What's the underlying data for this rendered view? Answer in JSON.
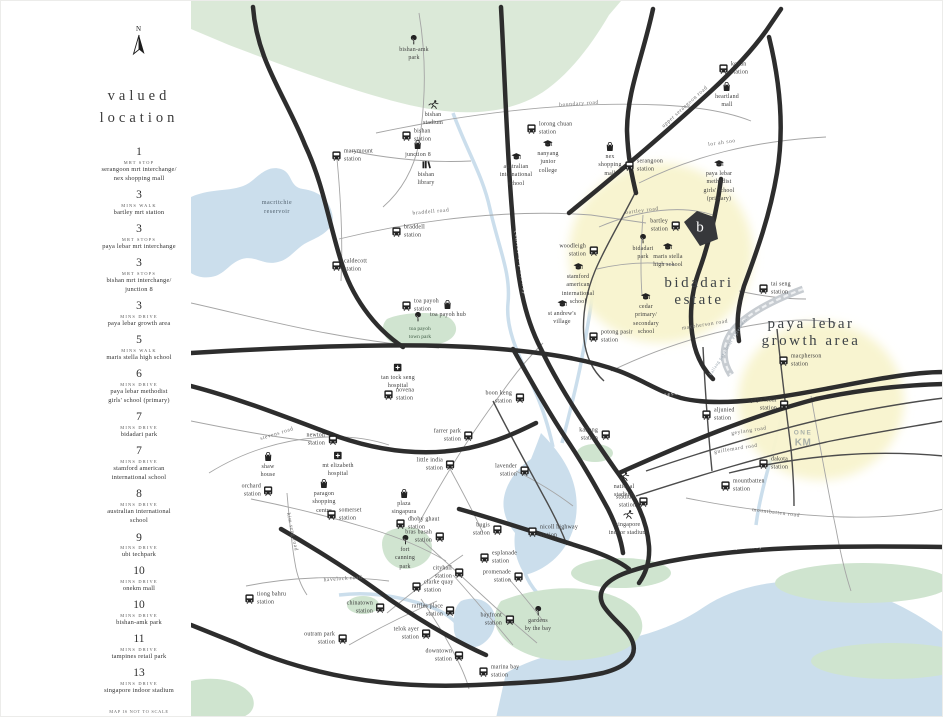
{
  "sidebar": {
    "compass": "N",
    "title": "valued\nlocation",
    "items": [
      {
        "number": "1",
        "mode": "mrt stop",
        "name": "serangoon mrt interchange/\nnex shopping mall"
      },
      {
        "number": "3",
        "mode": "mins walk",
        "name": "bartley mrt station"
      },
      {
        "number": "3",
        "mode": "mrt stops",
        "name": "paya lebar mrt interchange"
      },
      {
        "number": "3",
        "mode": "mrt stops",
        "name": "bishan mrt interchange/\njunction 8"
      },
      {
        "number": "3",
        "mode": "mins drive",
        "name": "paya lebar growth area"
      },
      {
        "number": "5",
        "mode": "mins walk",
        "name": "maris stella high school"
      },
      {
        "number": "6",
        "mode": "mins drive",
        "name": "paya lebar methodist\ngirls' school (primary)"
      },
      {
        "number": "7",
        "mode": "mins drive",
        "name": "bidadari park"
      },
      {
        "number": "7",
        "mode": "mins drive",
        "name": "stamford american\ninternational school"
      },
      {
        "number": "8",
        "mode": "mins drive",
        "name": "australian international\nschool"
      },
      {
        "number": "9",
        "mode": "mins drive",
        "name": "ubi techpark"
      },
      {
        "number": "10",
        "mode": "mins drive",
        "name": "onekm mall"
      },
      {
        "number": "10",
        "mode": "mins drive",
        "name": "bishan-amk park"
      },
      {
        "number": "11",
        "mode": "mins drive",
        "name": "tampines retail park"
      },
      {
        "number": "13",
        "mode": "mins drive",
        "name": "singapore indoor stadium"
      }
    ],
    "footnote": "map is not to scale\ndrive time is based on smooth traffic"
  },
  "map": {
    "colors": {
      "highlight_yellow": "#f8f3cd",
      "water_blue": "#cbdeec",
      "park_green": "#dbe9d8",
      "road_black": "#2d2d2d"
    },
    "area_labels": [
      {
        "text": "bidadari\nestate",
        "x": 508,
        "y": 291
      },
      {
        "text": "paya lebar\ngrowth area",
        "x": 620,
        "y": 332
      }
    ],
    "water_labels": [
      {
        "text": "macritchie\nreservoir",
        "x": 86,
        "y": 207
      }
    ],
    "park_labels": [
      {
        "text": "toa payoh\ntown park",
        "x": 229,
        "y": 333
      }
    ],
    "road_labels": [
      {
        "text": "boundary road",
        "x": 388,
        "y": 103,
        "rot": -4
      },
      {
        "text": "upper serangoon road",
        "x": 494,
        "y": 106,
        "rot": -42
      },
      {
        "text": "lor ah soo",
        "x": 531,
        "y": 142,
        "rot": -8
      },
      {
        "text": "braddell road",
        "x": 240,
        "y": 211,
        "rot": -5
      },
      {
        "text": "bartley road",
        "x": 451,
        "y": 210,
        "rot": -7
      },
      {
        "text": "macpherson road",
        "x": 514,
        "y": 324,
        "rot": -9
      },
      {
        "text": "stevens road",
        "x": 86,
        "y": 433,
        "rot": -17
      },
      {
        "text": "kim seng road",
        "x": 101,
        "y": 531,
        "rot": 78
      },
      {
        "text": "havelock road",
        "x": 152,
        "y": 578,
        "rot": -4
      },
      {
        "text": "mountbatten road",
        "x": 585,
        "y": 512,
        "rot": 7
      },
      {
        "text": "geylang road",
        "x": 558,
        "y": 430,
        "rot": -9
      },
      {
        "text": "guillemard road",
        "x": 545,
        "y": 448,
        "rot": -9
      },
      {
        "text": "kallang paya lebar expressway",
        "x": 537,
        "y": 345,
        "rot": -58,
        "cls": "kpe"
      },
      {
        "text": "central expressway",
        "x": 329,
        "y": 262,
        "rot": 82,
        "cls": "white"
      },
      {
        "text": "pan island expressway",
        "x": 462,
        "y": 396,
        "rot": -8,
        "cls": "white"
      },
      {
        "text": "east coast parkway",
        "x": 540,
        "y": 547,
        "rot": -2,
        "cls": "white"
      }
    ],
    "pois": [
      {
        "icon": "tree",
        "x": 223,
        "y": 39,
        "pos": "below",
        "label": "bishan-amk\npark"
      },
      {
        "icon": "runner",
        "x": 242,
        "y": 104,
        "pos": "below",
        "label": "bishan\nstadium"
      },
      {
        "icon": "train",
        "x": 216,
        "y": 135,
        "pos": "right",
        "label": "bishan\nstation"
      },
      {
        "icon": "mall",
        "x": 227,
        "y": 144,
        "pos": "below",
        "label": "junction 8"
      },
      {
        "icon": "library",
        "x": 235,
        "y": 164,
        "pos": "below",
        "label": "bishan\nlibrary"
      },
      {
        "icon": "train",
        "x": 146,
        "y": 155,
        "pos": "right",
        "label": "marymount\nstation"
      },
      {
        "icon": "train",
        "x": 341,
        "y": 128,
        "pos": "right",
        "label": "lorong chuan\nstation"
      },
      {
        "icon": "school",
        "x": 357,
        "y": 143,
        "pos": "below",
        "label": "nanyang\njunior\ncollege"
      },
      {
        "icon": "school",
        "x": 325,
        "y": 156,
        "pos": "below",
        "label": "australian\ninternational\nschool"
      },
      {
        "icon": "mall",
        "x": 419,
        "y": 146,
        "pos": "below",
        "label": "nex\nshopping\nmall"
      },
      {
        "icon": "train",
        "x": 439,
        "y": 165,
        "pos": "right",
        "label": "serangoon\nstation"
      },
      {
        "icon": "train",
        "x": 533,
        "y": 68,
        "pos": "right",
        "label": "kovan\nstation"
      },
      {
        "icon": "mall",
        "x": 536,
        "y": 86,
        "pos": "below",
        "label": "heartland\nmall"
      },
      {
        "icon": "school",
        "x": 528,
        "y": 163,
        "pos": "below",
        "label": "paya lebar\nmethodist\ngirls' school\n(primary)"
      },
      {
        "icon": "train",
        "x": 484,
        "y": 225,
        "pos": "left",
        "label": "bartley\nstation"
      },
      {
        "icon": "train",
        "x": 402,
        "y": 250,
        "pos": "left",
        "label": "woodleigh\nstation"
      },
      {
        "icon": "tree",
        "x": 452,
        "y": 238,
        "pos": "below",
        "label": "bidadari\npark"
      },
      {
        "icon": "school",
        "x": 477,
        "y": 246,
        "pos": "below",
        "label": "maris stella\nhigh school"
      },
      {
        "icon": "school",
        "x": 387,
        "y": 266,
        "pos": "below",
        "label": "stamford\namerican\ninternational\nschool"
      },
      {
        "icon": "school",
        "x": 455,
        "y": 296,
        "pos": "below",
        "label": "cedar\nprimary/\nsecondary\nschool"
      },
      {
        "icon": "train",
        "x": 403,
        "y": 336,
        "pos": "right",
        "label": "potong pasir\nstation"
      },
      {
        "icon": "school",
        "x": 371,
        "y": 303,
        "pos": "below",
        "label": "st andrew's\nvillage"
      },
      {
        "icon": "train",
        "x": 573,
        "y": 288,
        "pos": "right",
        "label": "tai seng\nstation"
      },
      {
        "icon": "train",
        "x": 206,
        "y": 231,
        "pos": "right",
        "label": "braddell\nstation"
      },
      {
        "icon": "train",
        "x": 146,
        "y": 265,
        "pos": "right",
        "label": "caldecott\nstation"
      },
      {
        "icon": "train",
        "x": 216,
        "y": 305,
        "pos": "right",
        "label": "toa payoh\nstation"
      },
      {
        "icon": "mall",
        "x": 257,
        "y": 304,
        "pos": "below",
        "label": "toa payoh hub"
      },
      {
        "icon": "tree",
        "x": 227,
        "y": 316,
        "pos": "below",
        "label": ""
      },
      {
        "icon": "hospital",
        "x": 207,
        "y": 367,
        "pos": "below",
        "label": "tan tock seng\nhospital"
      },
      {
        "icon": "train",
        "x": 198,
        "y": 394,
        "pos": "right",
        "label": "novena\nstation"
      },
      {
        "icon": "train",
        "x": 141,
        "y": 439,
        "pos": "left",
        "label": "newton\nstation"
      },
      {
        "icon": "mall",
        "x": 77,
        "y": 456,
        "pos": "below",
        "label": "shaw\nhouse"
      },
      {
        "icon": "hospital",
        "x": 147,
        "y": 455,
        "pos": "below",
        "label": "mt elizabeth\nhospital"
      },
      {
        "icon": "train",
        "x": 77,
        "y": 490,
        "pos": "left",
        "label": "orchard\nstation"
      },
      {
        "icon": "mall",
        "x": 133,
        "y": 483,
        "pos": "below",
        "label": "paragon\nshopping\ncentre"
      },
      {
        "icon": "train",
        "x": 141,
        "y": 514,
        "pos": "right",
        "label": "somerset\nstation"
      },
      {
        "icon": "train",
        "x": 277,
        "y": 435,
        "pos": "left",
        "label": "farrer park\nstation"
      },
      {
        "icon": "train",
        "x": 259,
        "y": 464,
        "pos": "left",
        "label": "little india\nstation"
      },
      {
        "icon": "mall",
        "x": 213,
        "y": 493,
        "pos": "below",
        "label": "plaza\nsingapura"
      },
      {
        "icon": "train",
        "x": 210,
        "y": 523,
        "pos": "right",
        "label": "dhoby ghaut\nstation"
      },
      {
        "icon": "train",
        "x": 248,
        "y": 536,
        "pos": "left",
        "label": "bras basah\nstation"
      },
      {
        "icon": "tree",
        "x": 214,
        "y": 539,
        "pos": "below",
        "label": "fort\ncanning\npark"
      },
      {
        "icon": "train",
        "x": 328,
        "y": 397,
        "pos": "left",
        "label": "boon keng\nstation"
      },
      {
        "icon": "train",
        "x": 414,
        "y": 434,
        "pos": "left",
        "label": "kallang\nstation"
      },
      {
        "icon": "train",
        "x": 333,
        "y": 470,
        "pos": "left",
        "label": "lavender\nstation"
      },
      {
        "icon": "train",
        "x": 306,
        "y": 529,
        "pos": "left",
        "label": "bugis\nstation"
      },
      {
        "icon": "train",
        "x": 342,
        "y": 531,
        "pos": "right",
        "label": "nicoll highway\nstation"
      },
      {
        "icon": "train",
        "x": 294,
        "y": 557,
        "pos": "right",
        "label": "esplanade\nstation"
      },
      {
        "icon": "train",
        "x": 327,
        "y": 576,
        "pos": "left",
        "label": "promenade\nstation"
      },
      {
        "icon": "train",
        "x": 268,
        "y": 572,
        "pos": "left",
        "label": "cityhall\nstation"
      },
      {
        "icon": "train",
        "x": 226,
        "y": 586,
        "pos": "right",
        "label": "clarke quay\nstation"
      },
      {
        "icon": "train",
        "x": 259,
        "y": 610,
        "pos": "left",
        "label": "raffles place\nstation"
      },
      {
        "icon": "train",
        "x": 235,
        "y": 633,
        "pos": "left",
        "label": "telok ayer\nstation"
      },
      {
        "icon": "train",
        "x": 189,
        "y": 607,
        "pos": "left",
        "label": "chinatown\nstation"
      },
      {
        "icon": "train",
        "x": 151,
        "y": 638,
        "pos": "left",
        "label": "outram park\nstation"
      },
      {
        "icon": "train",
        "x": 59,
        "y": 598,
        "pos": "right",
        "label": "tiong bahru\nstation"
      },
      {
        "icon": "train",
        "x": 268,
        "y": 655,
        "pos": "left",
        "label": "downtown\nstation"
      },
      {
        "icon": "train",
        "x": 293,
        "y": 671,
        "pos": "right",
        "label": "marina bay\nstation"
      },
      {
        "icon": "train",
        "x": 318,
        "y": 619,
        "pos": "left",
        "label": "bayfront\nstation"
      },
      {
        "icon": "tree",
        "x": 347,
        "y": 610,
        "pos": "below",
        "label": "gardens\nby the bay"
      },
      {
        "icon": "runner",
        "x": 433,
        "y": 476,
        "pos": "below",
        "label": "national\nstadium"
      },
      {
        "icon": "train",
        "x": 452,
        "y": 501,
        "pos": "left",
        "label": "stadium\nstation"
      },
      {
        "icon": "runner",
        "x": 437,
        "y": 514,
        "pos": "below",
        "label": "singapore\nindoor stadium"
      },
      {
        "icon": "train",
        "x": 516,
        "y": 414,
        "pos": "right",
        "label": "aljunied\nstation"
      },
      {
        "icon": "train",
        "x": 593,
        "y": 360,
        "pos": "right",
        "label": "macpherson\nstation"
      },
      {
        "icon": "train",
        "x": 593,
        "y": 404,
        "pos": "left",
        "label": "paya lebar\nstation"
      },
      {
        "icon": "train",
        "x": 573,
        "y": 463,
        "pos": "right",
        "label": "dakota\nstation"
      },
      {
        "icon": "train",
        "x": 535,
        "y": 485,
        "pos": "right",
        "label": "mountbatten\nstation"
      }
    ],
    "b_logo": {
      "letter": "b",
      "x": 509,
      "y": 228
    },
    "onekm_logo": {
      "line1": "ONE",
      "line2": "KM",
      "x": 612,
      "y": 438
    }
  }
}
